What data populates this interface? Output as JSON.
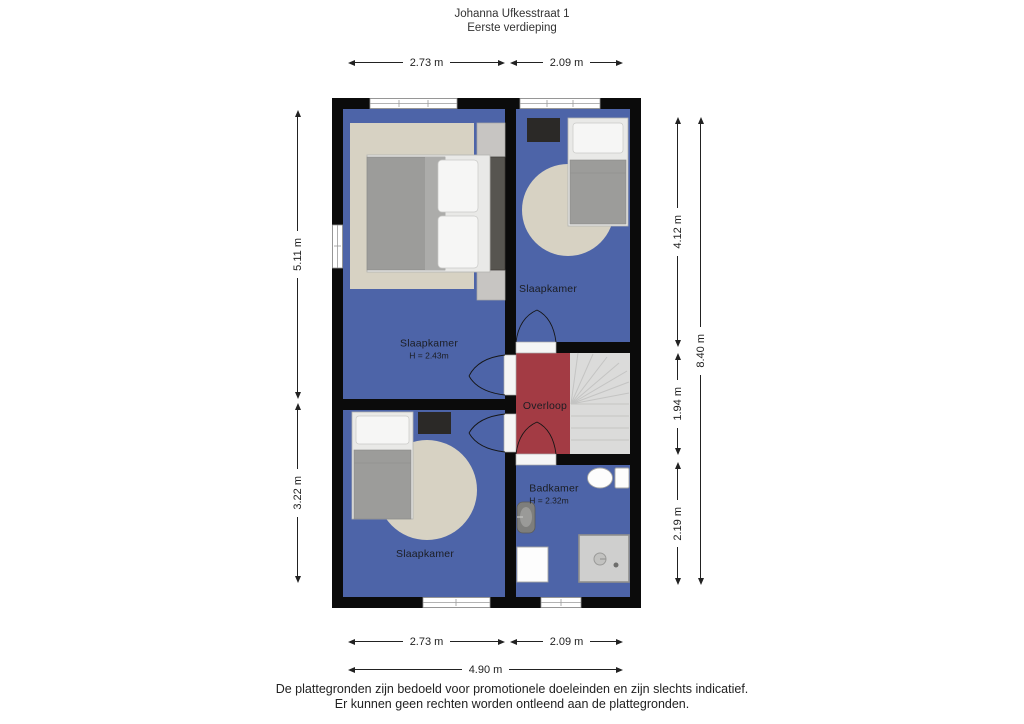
{
  "title": {
    "line1": "Johanna Ufkesstraat 1",
    "line2": "Eerste verdieping"
  },
  "rooms": {
    "bedroom_top_left": {
      "label": "Slaapkamer",
      "ceiling": "H = 2.43m"
    },
    "bedroom_top_right": {
      "label": "Slaapkamer"
    },
    "bedroom_bottom_left": {
      "label": "Slaapkamer"
    },
    "landing": {
      "label": "Overloop"
    },
    "bathroom": {
      "label": "Badkamer",
      "ceiling": "H = 2.32m"
    }
  },
  "dimensions": {
    "top_left_width": "2.73 m",
    "top_right_width": "2.09 m",
    "bottom_left_width": "2.73 m",
    "bottom_right_width": "2.09 m",
    "bottom_total_width": "4.90 m",
    "left_upper_height": "5.11 m",
    "left_lower_height": "3.22 m",
    "right_top_height": "4.12 m",
    "right_middle_height": "1.94 m",
    "right_bottom_height": "2.19 m",
    "right_total_height": "8.40 m"
  },
  "footer": {
    "line1": "De plattegronden zijn bedoeld voor promotionele doeleinden en zijn slechts indicatief.",
    "line2": "Er kunnen geen rechten worden ontleend aan de plattegronden."
  },
  "colors": {
    "floor": "#4D64A8",
    "landing": "#A33B44",
    "wall": "#0B0B0B",
    "rug": "#D7D2C3",
    "stairs": "#DBDBDA"
  }
}
